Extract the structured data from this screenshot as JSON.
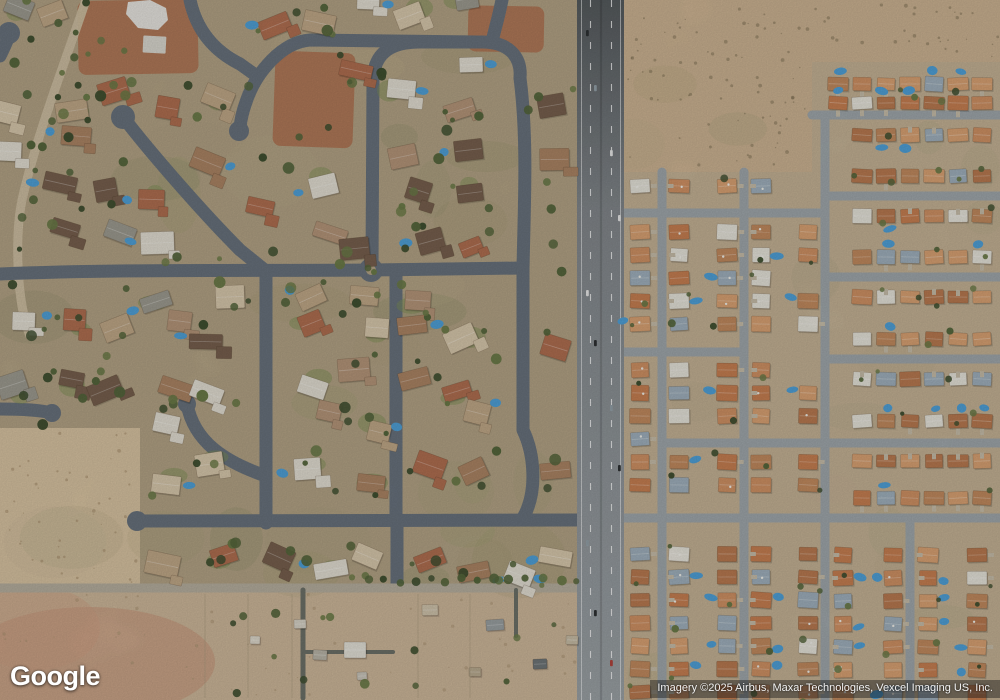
{
  "branding": {
    "logo_text": "Google"
  },
  "attribution": {
    "text": "Imagery ©2025 Airbus, Maxar Technologies, Vexcel Imaging US, Inc."
  },
  "map": {
    "type": "satellite",
    "scene": "desert suburban neighborhoods with north-south arterial road",
    "palette": {
      "desert_base": "#c9b190",
      "desert_light": "#d8c3a1",
      "desert_speckle": "#7d6f54",
      "desert_speckle_light": "#a8916f",
      "left_ground": "#b3a385",
      "mottle": [
        "#8e8e66",
        "#c2b492",
        "#7e8560",
        "#a59a76",
        "#97a06c"
      ],
      "red_dirt": "#b06f4e",
      "rural_ground": "#cdb79a",
      "rural_pink": "#c59175",
      "street_dark": "#68727d",
      "street_light": "#9fa7ab",
      "road_top": "#565b5e",
      "road_mid": "#82878b",
      "road_bottom": "#9ba1a5",
      "rural_road": "#b6ae9e",
      "drive_dark": "#6d7168",
      "island_tan": "#b3a385",
      "roof_right": [
        "#cf9164",
        "#c67f52",
        "#d9a273",
        "#c18a5e",
        "#b87a50",
        "#9fb0bc",
        "#e6e3da"
      ],
      "roof_left": [
        "#c0a888",
        "#ab8464",
        "#b06f51",
        "#9d9b90",
        "#77604e",
        "#d8c8ac",
        "#e2ded2",
        "#b5967a"
      ],
      "white_roof": "#e8e6e0",
      "pool": "#4fa0d8",
      "tree": [
        "#3f4f30",
        "#55663c",
        "#6b7b48"
      ],
      "lawn": "#7d9055",
      "driveway": "#c6bda9",
      "car": [
        "#e8e8e8",
        "#2e3133",
        "#93a0a8",
        "#b0443c",
        "#7f92a0"
      ]
    }
  }
}
